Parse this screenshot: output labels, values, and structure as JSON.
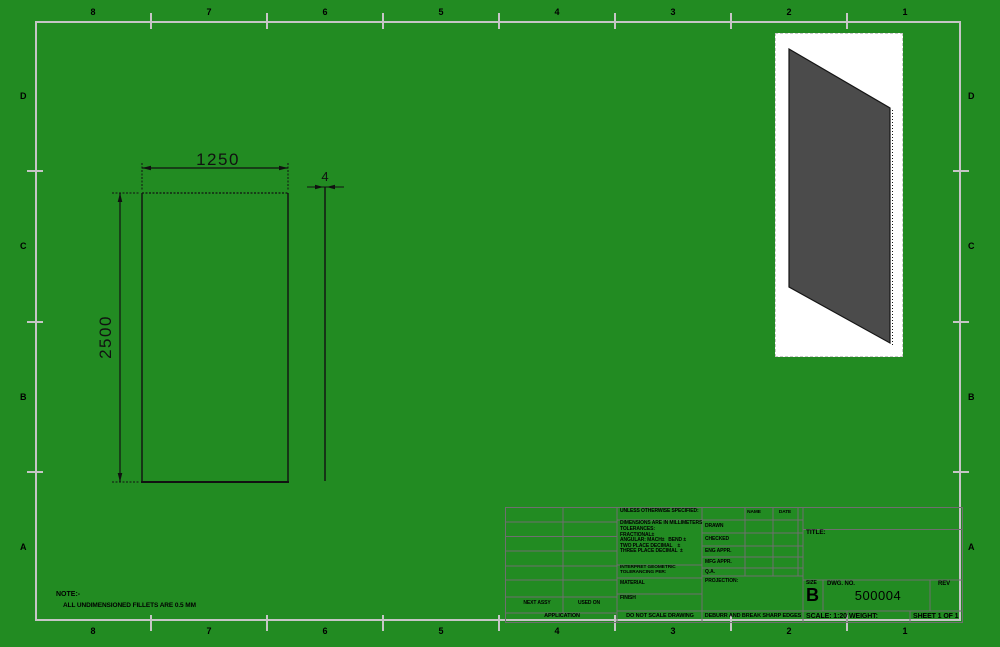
{
  "colors": {
    "background": "#228b22",
    "frame": "#c6c6c6",
    "drawing_line": "#111111",
    "iso_fill": "#4b4b4b",
    "viewport_background": "#ffffff",
    "titleblock_grid": "#6f6f6f"
  },
  "zones": {
    "top": [
      "8",
      "7",
      "6",
      "5",
      "4",
      "3",
      "2",
      "1"
    ],
    "bottom": [
      "8",
      "7",
      "6",
      "5",
      "4",
      "3",
      "2",
      "1"
    ],
    "left": [
      "D",
      "C",
      "B",
      "A"
    ],
    "right": [
      "D",
      "C",
      "B",
      "A"
    ]
  },
  "dimensions": {
    "width": "1250",
    "height": "2500",
    "thickness": "4"
  },
  "note": {
    "heading": "NOTE:-",
    "body": "ALL UNDIMENSIONED FILLETS ARE 0.5 MM"
  },
  "title_block": {
    "unless": "UNLESS OTHERWISE SPECIFIED:",
    "tolerances": [
      "DIMENSIONS ARE IN MILLIMETERS",
      "TOLERANCES:",
      "FRACTIONAL±",
      "ANGULAR: MACH±   BEND ±",
      "TWO PLACE DECIMAL    ±",
      "THREE PLACE DECIMAL  ±"
    ],
    "interpret_1": "INTERPRET GEOMETRIC",
    "interpret_2": "TOLERANCING PER:",
    "material": "MATERIAL",
    "finish": "FINISH",
    "name_header": "NAME",
    "date_header": "DATE",
    "approvals": [
      "DRAWN",
      "CHECKED",
      "ENG APPR.",
      "MFG APPR.",
      "Q.A."
    ],
    "projection": "PROJECTION:",
    "title": "TITLE:",
    "size_label": "SIZE",
    "size": "B",
    "dwg_label": "DWG. NO.",
    "dwg_no": "500004",
    "rev": "REV",
    "scale": "SCALE: 1:20",
    "weight": "WEIGHT:",
    "sheet": "SHEET 1 OF 1",
    "next_assy": "NEXT ASSY",
    "used_on": "USED ON",
    "application": "APPLICATION",
    "do_not_scale": "DO NOT SCALE DRAWING",
    "deburr": "DEBURR AND BREAK SHARP EDGES"
  }
}
